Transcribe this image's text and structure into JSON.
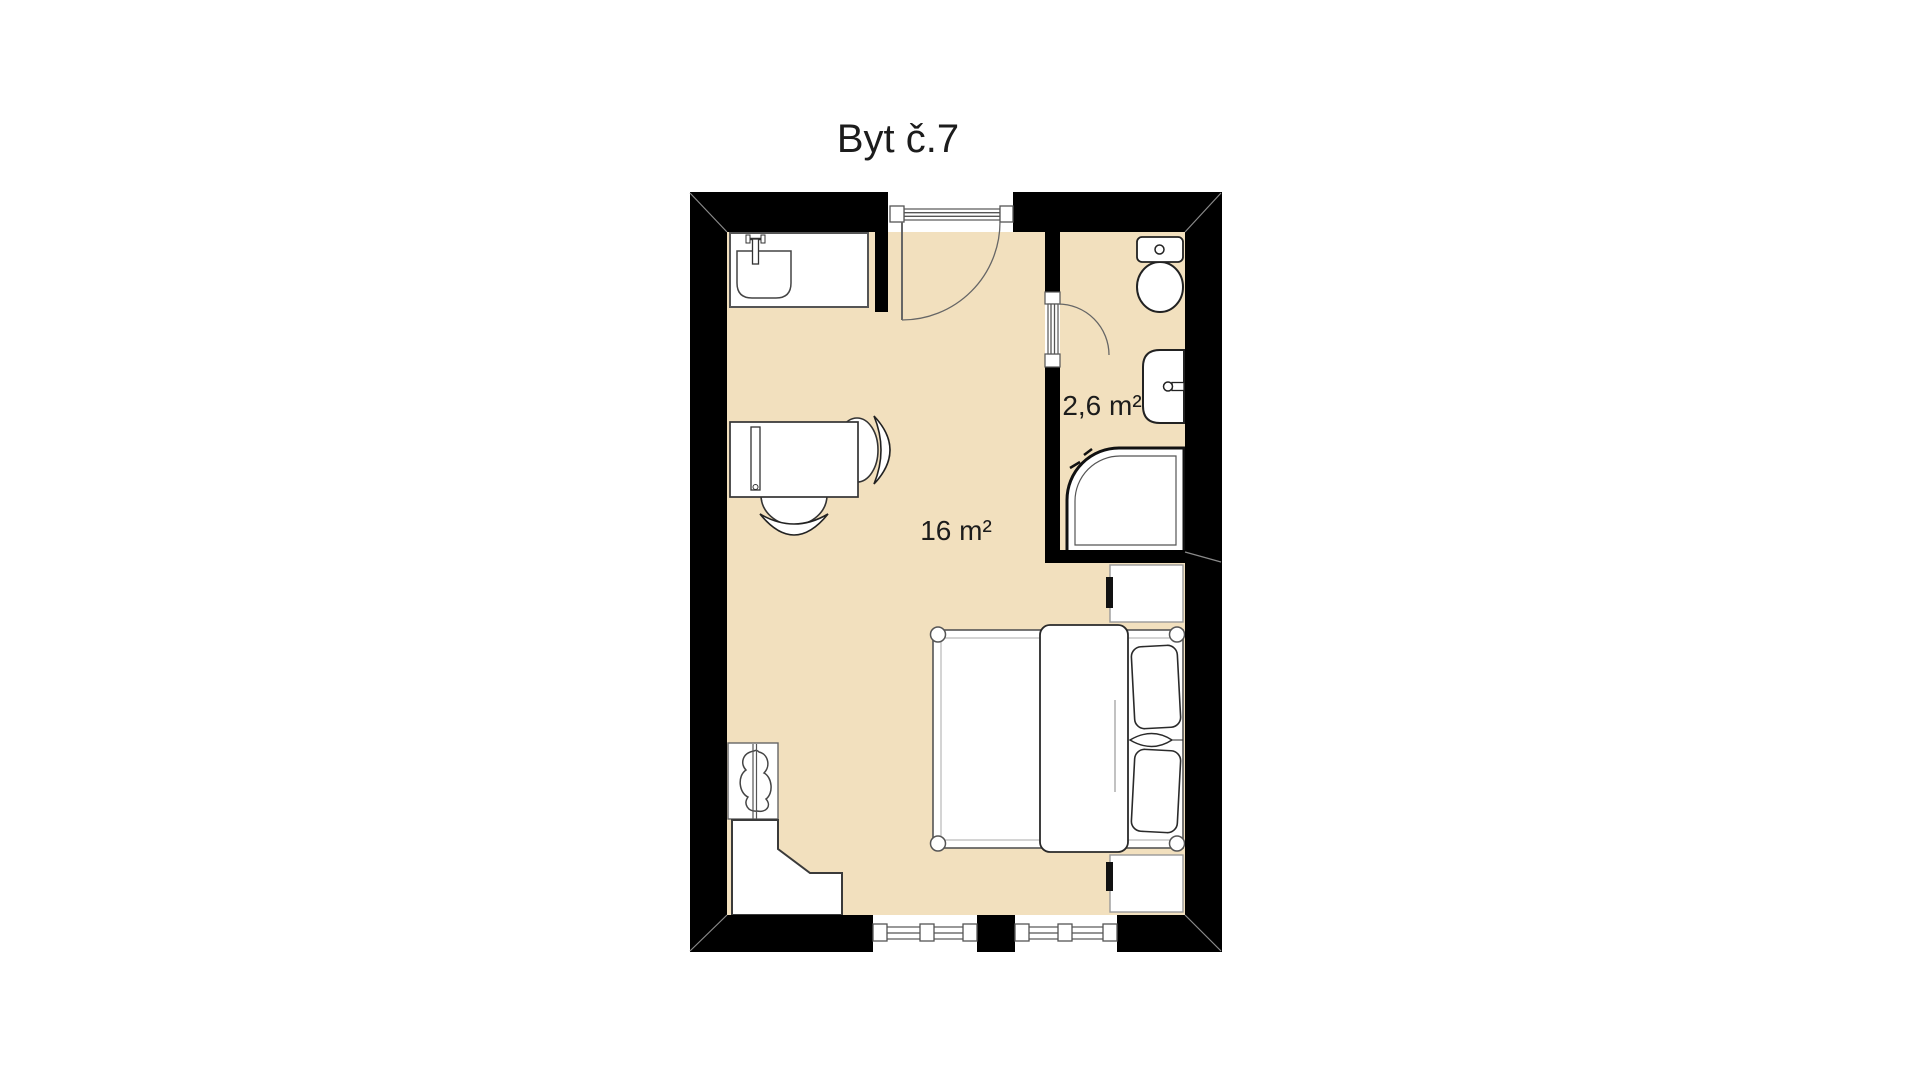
{
  "title": "Byt č.7",
  "rooms": {
    "living": {
      "label": "16 m²"
    },
    "bathroom": {
      "label": "2,6 m²"
    }
  },
  "fixtures": [
    "kitchen-sink",
    "entrance-door",
    "bathroom-door",
    "toilet",
    "washbasin",
    "shower",
    "bed",
    "pillows",
    "duvet",
    "nightstand",
    "desk",
    "monitor",
    "desk-chair",
    "side-chair",
    "wardrobe-rail",
    "corner-counter",
    "window"
  ],
  "colors": {
    "background": "#ffffff",
    "floor": "#f2e0be",
    "wall": "#000000",
    "outline": "#2a2a2a",
    "frame": "#555555",
    "text": "#1c1c1c"
  }
}
